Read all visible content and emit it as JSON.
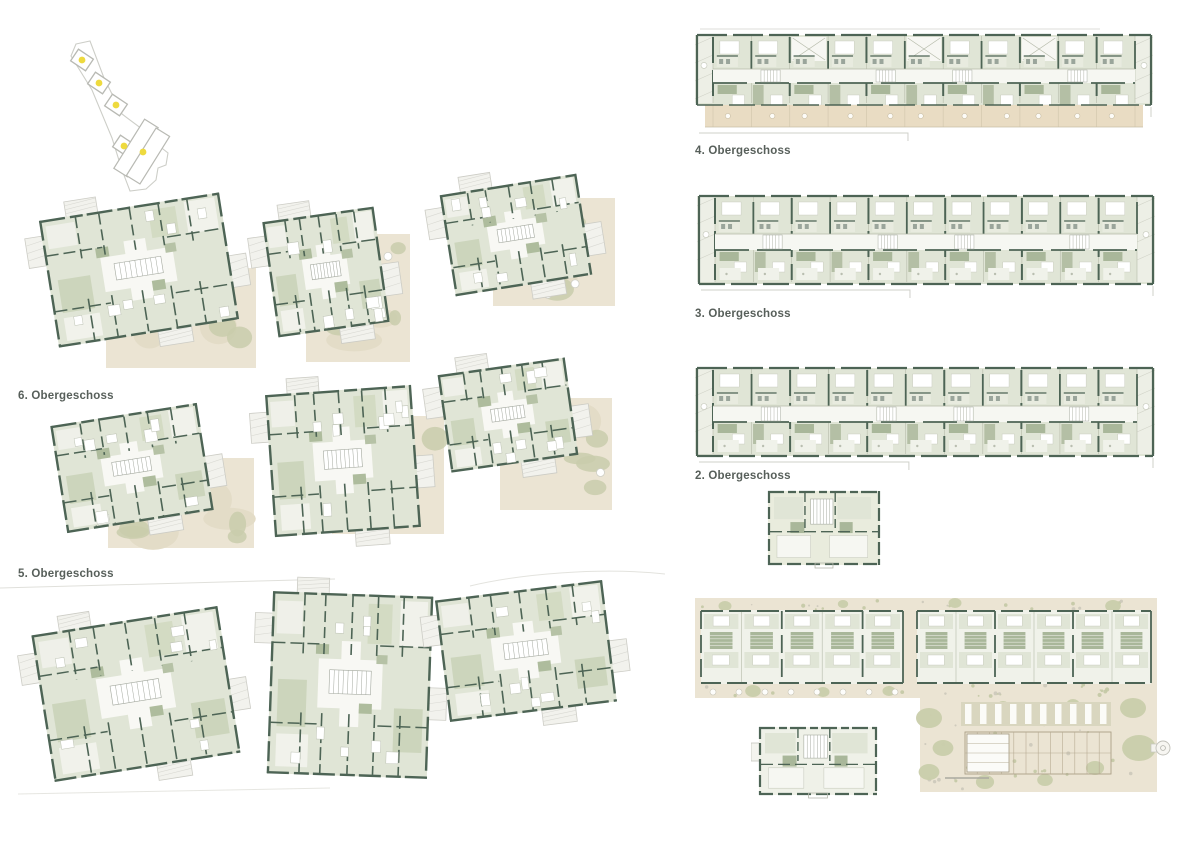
{
  "sheet": {
    "background": "#ffffff",
    "kind": "architectural floor plan presentation sheet"
  },
  "labels": {
    "floor6": "6. Obergeschoss",
    "floor5": "5. Obergeschoss",
    "floor4": "4. Obergeschoss",
    "floor3": "3. Obergeschoss",
    "floor2": "2. Obergeschoss"
  },
  "palette": {
    "wall": "#4d6455",
    "room_green": "#e0e5d6",
    "room_green_dark": "#ccd5bc",
    "pod_olive": "#a9b79a",
    "corridor_white": "#f8f8f4",
    "landscape_beige": "#ebe4d3",
    "landscape_blob": "#c9cdab",
    "landscape_sand": "#e3dcc7",
    "balcony_beige": "#e9dcc3",
    "outline_gray": "#cfd0ca",
    "key_dot": "#eeda3e",
    "label_text": "#575f5a"
  },
  "site_key": {
    "marker_count": 5,
    "small_buildings": 4,
    "large_buildings": 2
  },
  "plan_groups": {
    "left_tower_plans": 9,
    "right_bar_plans": 3,
    "small_house_plans": 2,
    "ground_floor_site_plan": 1
  }
}
